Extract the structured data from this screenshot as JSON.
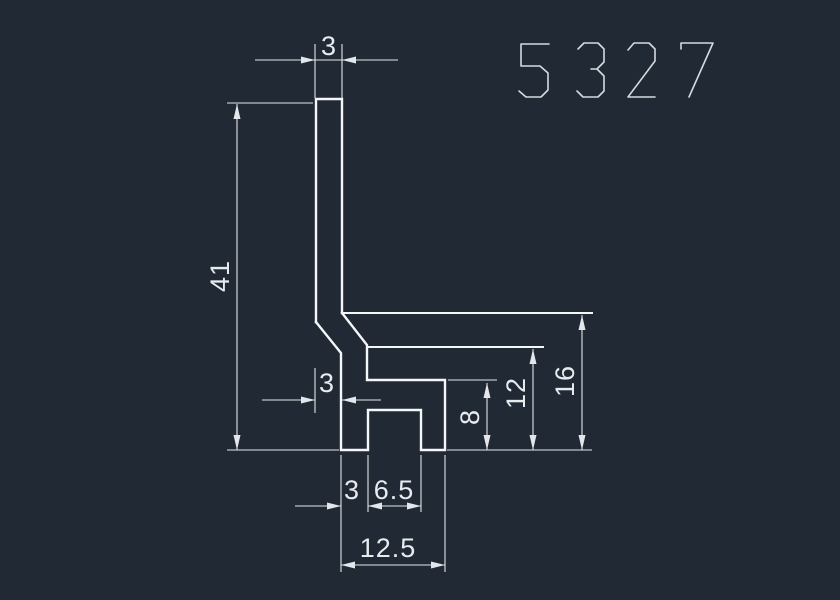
{
  "title": {
    "part_number": "5327"
  },
  "colors": {
    "background": "#212935",
    "object_line": "#f5f6f7",
    "dimension_line": "#e3e7ea",
    "dimension_text": "#e8ebed",
    "title_outline": "#d6dade"
  },
  "dims": {
    "top_width": "3",
    "overall_height": "41",
    "jog_offset": "3",
    "notch_depth": "8",
    "step_height": "12",
    "arm_height": "16",
    "foot_left": "3",
    "notch_width": "6.5",
    "foot_width": "12.5"
  }
}
